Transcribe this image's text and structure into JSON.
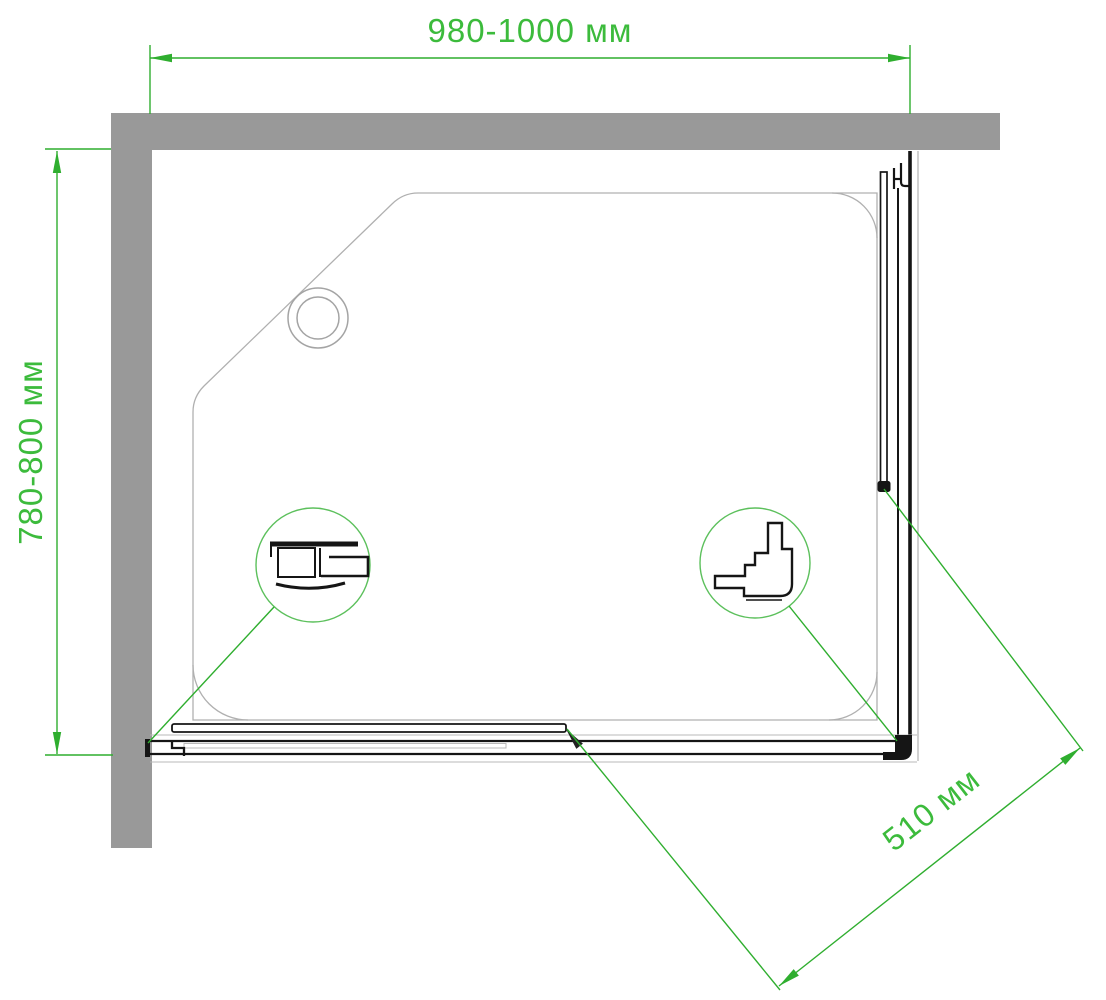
{
  "drawing": {
    "dimensions": {
      "width_label": "980-1000 мм",
      "depth_label": "780-800 мм",
      "diagonal_label": "510 мм"
    },
    "colors": {
      "dimension_line_green": "#2fae2f",
      "dimension_text_green": "#3cbb3c",
      "callout_circle_green": "#5cc05c",
      "wall_gray": "#999999",
      "tray_outline_gray": "#b0b0b0",
      "profile_black": "#151515"
    }
  }
}
